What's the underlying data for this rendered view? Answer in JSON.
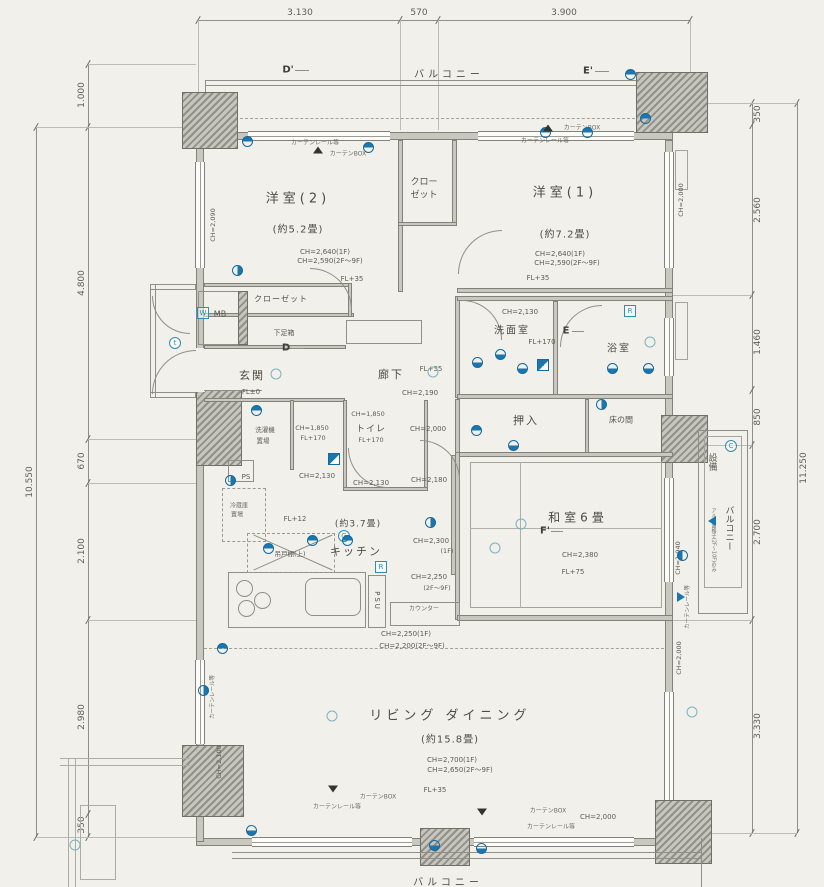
{
  "dims": {
    "top": [
      "3.130",
      "570",
      "3.900"
    ],
    "left_total": "10.550",
    "left": [
      "1.000",
      "4.800",
      "670",
      "2.100",
      "2.980",
      "350"
    ],
    "right_total": "11.250",
    "right": [
      "350",
      "2.560",
      "1.460",
      "850",
      "2.700",
      "3.330"
    ]
  },
  "markers": {
    "d_top": "D'",
    "e_top": "E'",
    "d": "D",
    "e": "E",
    "f": "F'"
  },
  "badges": {
    "w": "W",
    "t": "t",
    "r_bath": "R",
    "r_kitchen": "R",
    "g": "G",
    "ps": "PS",
    "psu": "PSU"
  },
  "balcony": {
    "top": "バルコニー",
    "bottom": "バルコニー"
  },
  "equip_balcony": {
    "title": "設備",
    "title2": "バルコニー",
    "note": "アルミ面格子(2F〜10F)のみ"
  },
  "rooms": {
    "bedroom2": {
      "name": "洋室(2)",
      "size": "(約5.2畳)",
      "ch1": "CH=2,640(1F)",
      "ch2": "CH=2,590(2F〜9F)",
      "fl": "FL+35",
      "side_ch": "CH=2,090"
    },
    "bedroom1": {
      "name": "洋室(1)",
      "size": "(約7.2畳)",
      "ch1": "CH=2,640(1F)",
      "ch2": "CH=2,590(2F〜9F)",
      "fl": "FL+35",
      "side_ch": "CH=2,000"
    },
    "closet_top": {
      "l1": "クロー",
      "l2": "ゼット"
    },
    "closet2": "クローゼット",
    "mb": "MB",
    "genkan": {
      "name": "玄関",
      "fl": "FL±0"
    },
    "shoe": "下足箱",
    "hall": {
      "name": "廊下",
      "fl": "FL+35",
      "ch": "CH=2,190"
    },
    "wash": {
      "name": "洗面室",
      "ch": "CH=2,130",
      "fl": "FL+170"
    },
    "bath": "浴室",
    "oshiire": "押入",
    "tokonoma": "床の間",
    "toilet": {
      "name": "トイレ",
      "ch": "CH=1,850",
      "fl": "FL+170"
    },
    "laundry": {
      "l1": "洗濯機",
      "l2": "置場",
      "ch": "CH=1,850",
      "fl": "FL+170"
    },
    "fridge": {
      "l1": "冷蔵庫",
      "l2": "置場"
    },
    "kitchen": {
      "name": "キッチン",
      "size": "(約3.7畳)",
      "fl": "FL+12",
      "cupboard": "吊戸棚(上)",
      "counter": "カウンター"
    },
    "washitsu": {
      "name": "和室6畳",
      "ch": "CH=2,380",
      "fl": "FL+75",
      "side_ch": "CH=1,940"
    },
    "living": {
      "name": "リビング ダイニング",
      "size": "(約15.8畳)",
      "ch1": "CH=2,700(1F)",
      "ch2": "CH=2,650(2F〜9F)",
      "fl": "FL+35"
    }
  },
  "ch_notes": {
    "hall_nook": "CH=2,000",
    "k1": "CH=2,130",
    "k2": "CH=2,130",
    "k3": "CH=2,180",
    "k4": "CH=2,300",
    "k4b": "(1F)",
    "k5": "CH=2,250",
    "k5b": "(2F〜9F)",
    "soffit1": "CH=2,250(1F)",
    "soffit2": "CH=2,200(2F〜9F)",
    "ld_right": "CH=2,000",
    "ld_bottom": "CH=2,000",
    "ld_left": "CH=2,100"
  },
  "window_notes": {
    "rail1": "カーテンレール等",
    "box1": "カーテンBOX",
    "rail2": "カーテンレール等",
    "box2": "カーテンBOX",
    "rail3": "カーテンレール等",
    "box3": "カーテンBOX",
    "rail4": "カーテンレール等",
    "box4": "カーテンBOX",
    "rail_left": "カーテンレール等",
    "rail_right": "カーテンレール等"
  },
  "icons": {
    "electrical_half_circle": "blue ceiling-light / outlet symbol",
    "teal_circle": "light fixture symbol",
    "blue_square": "switch panel symbol",
    "section_triangle": "curtain box / section mark",
    "blue_arrow": "wall vent symbol"
  }
}
